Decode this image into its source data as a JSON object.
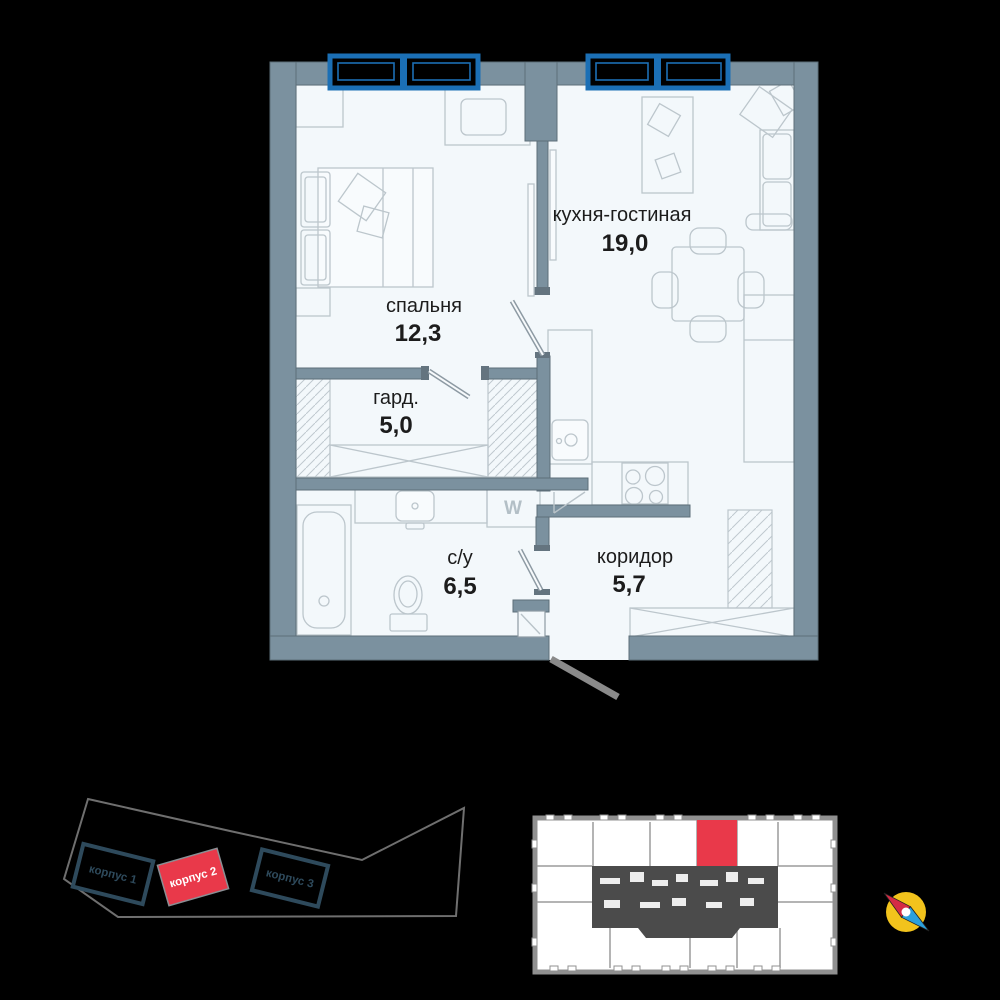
{
  "palette": {
    "background": "#000000",
    "floor": "#f3f8fb",
    "wall": "#7b919f",
    "window_frame": "#1b6fb5",
    "accent_red": "#e9394a",
    "site_outline": "#6f6f6f",
    "building_outline": "#2e4a5c",
    "keyplan_wall": "#909090",
    "keyplan_core": "#4b4b4b",
    "compass_yellow": "#f2c31c",
    "compass_red": "#d42b45",
    "compass_blue": "#2ba0dc",
    "label_ink": "#1c1c1c"
  },
  "floor_plan": {
    "rooms": [
      {
        "id": "kitchen-living",
        "name": "кухня-гостиная",
        "area": "19,0"
      },
      {
        "id": "bedroom",
        "name": "спальня",
        "area": "12,3"
      },
      {
        "id": "wardrobe",
        "name": "гард.",
        "area": "5,0"
      },
      {
        "id": "bathroom",
        "name": "с/у",
        "area": "6,5"
      },
      {
        "id": "corridor",
        "name": "коридор",
        "area": "5,7"
      }
    ],
    "washer_label": "W"
  },
  "site_plan": {
    "buildings": [
      {
        "label": "корпус 1",
        "highlighted": false
      },
      {
        "label": "корпус 2",
        "highlighted": true
      },
      {
        "label": "корпус 3",
        "highlighted": false
      }
    ]
  },
  "icons": {
    "compass": "compass-icon"
  }
}
